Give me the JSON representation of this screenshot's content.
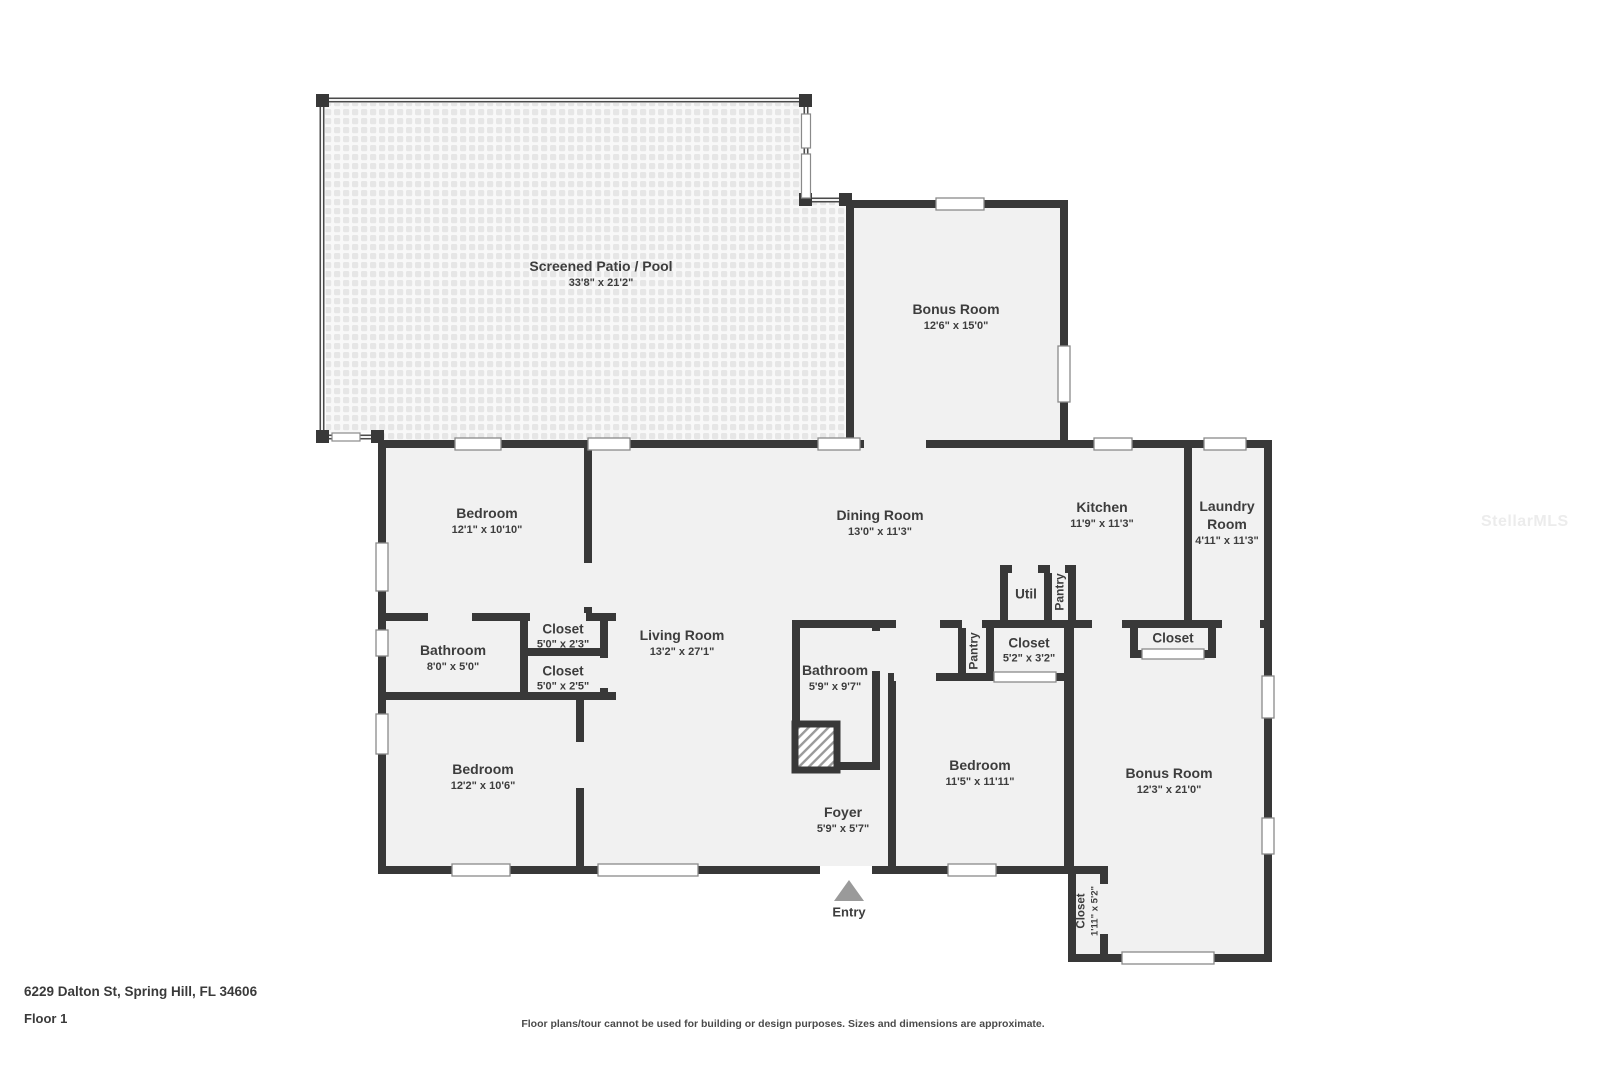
{
  "meta": {
    "address": "6229 Dalton St, Spring Hill, FL 34606",
    "floor_label": "Floor 1",
    "disclaimer": "Floor plans/tour cannot be used for building or design purposes. Sizes and dimensions are approximate.",
    "watermark": "StellarMLS"
  },
  "palette": {
    "wall": "#383838",
    "room_fill": "#f1f1f1",
    "label_text": "#3d3d3d",
    "entry_arrow": "#9a9a9a",
    "window_frame": "#8a8a8a"
  },
  "rooms": {
    "patio": {
      "name": "Screened Patio / Pool",
      "dims": "33'8\" x 21'2\""
    },
    "bonus_top": {
      "name": "Bonus Room",
      "dims": "12'6\" x 15'0\""
    },
    "bedroom_tl": {
      "name": "Bedroom",
      "dims": "12'1\" x 10'10\""
    },
    "dining": {
      "name": "Dining Room",
      "dims": "13'0\" x 11'3\""
    },
    "kitchen": {
      "name": "Kitchen",
      "dims": "11'9\" x 11'3\""
    },
    "laundry": {
      "name": "Laundry Room",
      "dims": "4'11\" x 11'3\""
    },
    "util": {
      "name": "Util"
    },
    "pantry_kitchen": {
      "name": "Pantry"
    },
    "bathroom_left": {
      "name": "Bathroom",
      "dims": "8'0\" x 5'0\""
    },
    "closet_a": {
      "name": "Closet",
      "dims": "5'0\" x 2'3\""
    },
    "closet_b": {
      "name": "Closet",
      "dims": "5'0\" x 2'5\""
    },
    "living": {
      "name": "Living Room",
      "dims": "13'2\" x 27'1\""
    },
    "bathroom_center": {
      "name": "Bathroom",
      "dims": "5'9\" x 9'7\""
    },
    "pantry_hall": {
      "name": "Pantry"
    },
    "closet_center": {
      "name": "Closet",
      "dims": "5'2\" x 3'2\""
    },
    "closet_right": {
      "name": "Closet"
    },
    "bedroom_center": {
      "name": "Bedroom",
      "dims": "11'5\" x 11'11\""
    },
    "bonus_bottom": {
      "name": "Bonus Room",
      "dims": "12'3\" x 21'0\""
    },
    "foyer": {
      "name": "Foyer",
      "dims": "5'9\" x 5'7\""
    },
    "closet_hall": {
      "name": "Closet",
      "dims": "1'11\" x 5'2\""
    },
    "bedroom_bl": {
      "name": "Bedroom",
      "dims": "12'2\" x 10'6\""
    }
  },
  "markers": {
    "entry": "Entry"
  }
}
